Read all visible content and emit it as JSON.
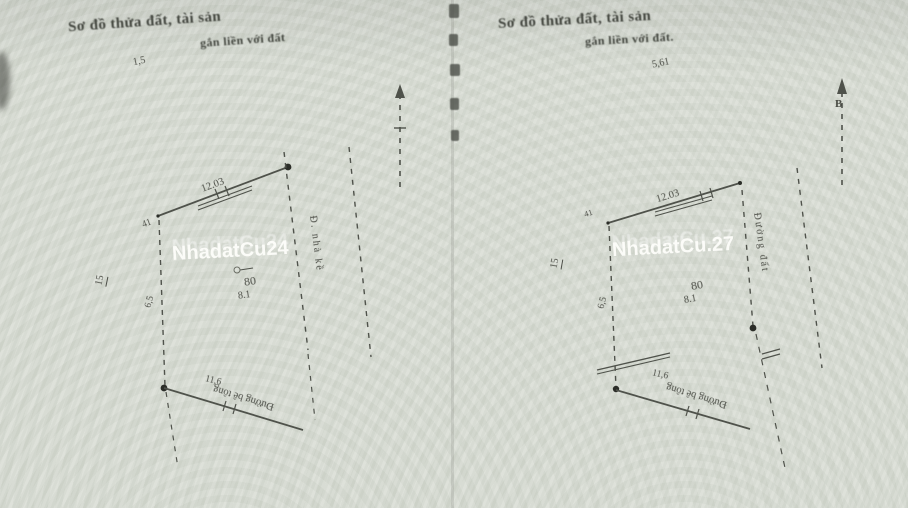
{
  "left": {
    "title_a": "Sơ đồ thửa đất, tài sản",
    "title_b": "gắn liền với đất",
    "watermark": "NhadatCu24",
    "offset_dim": "1,5",
    "corner_label": "41",
    "dim_top": "12.03",
    "adjacent_parcel": "15",
    "dim_left": "6,5",
    "plot_number": "80",
    "plot_area": "8.1",
    "dim_bottom": "11,6",
    "road_label": "Đường bê tông",
    "side_label": "Đ. nhà kề"
  },
  "right": {
    "title_a": "Sơ đồ thửa đất, tài sản",
    "title_b": "gắn liền với đất.",
    "watermark": "NhadatCu.27",
    "offset_dim": "5,61",
    "north_label": "B",
    "corner_label": "41",
    "dim_top": "12.03",
    "adjacent_parcel": "15",
    "dim_left": "6,5",
    "plot_number": "80",
    "plot_area": "8.1",
    "dim_bottom": "11,6",
    "road_label": "Đường bê tông",
    "side_label": "Đường đất"
  },
  "colors": {
    "paper": "#d8dcd4",
    "ink": "#4f524b",
    "watermark": "#fdfdfa"
  }
}
